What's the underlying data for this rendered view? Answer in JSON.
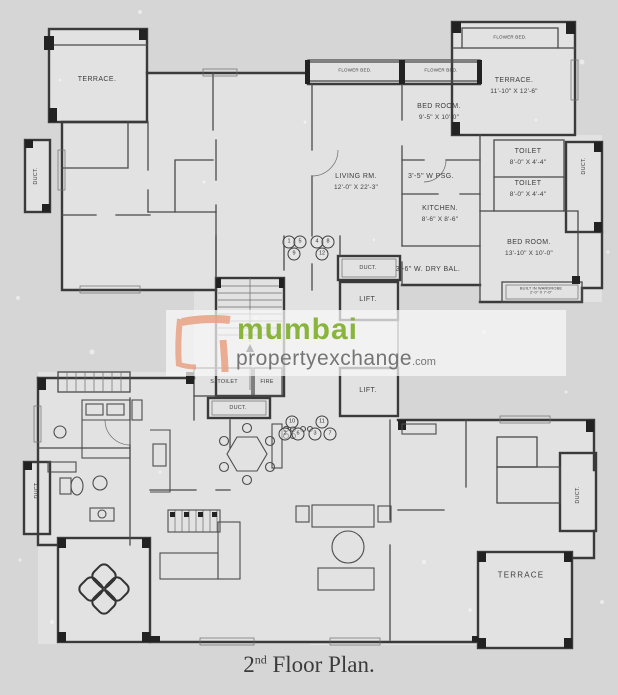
{
  "page": {
    "background": "#d6d6d6",
    "wall_color": "#3a3a3a"
  },
  "watermark": {
    "brand_green_text": "mumbai",
    "brand_gray_text": "propertyexchange",
    "brand_suffix": ".com",
    "green": "#8ab53c",
    "gray": "#757575",
    "logo_orange": "#e9a284"
  },
  "caption": {
    "prefix": "2",
    "ordinal": "nd",
    "rest": " Floor Plan."
  },
  "plan": {
    "rooms": {
      "terrace_tl": {
        "name": "TERRACE."
      },
      "duct_left_top": {
        "name": "DUCT."
      },
      "flower_bed_1": {
        "name": "FLOWER BED."
      },
      "flower_bed_2": {
        "name": "FLOWER BED."
      },
      "flower_bed_3": {
        "name": "FLOWER BED."
      },
      "bed_room_top": {
        "name": "BED ROOM.",
        "dims": "9'-5\" X 10'-0\""
      },
      "living_rm": {
        "name": "LIVING RM.",
        "dims": "12'-0\" X 22'-3\""
      },
      "psg": {
        "name": "3'-5\" W PSG."
      },
      "kitchen": {
        "name": "KITCHEN.",
        "dims": "8'-6\" X 8'-6\""
      },
      "terrace_tr": {
        "name": "TERRACE.",
        "dims": "11'-10\" X 12'-6\""
      },
      "toilet_1": {
        "name": "TOILET",
        "dims": "8'-0\" X 4'-4\""
      },
      "toilet_2": {
        "name": "TOILET",
        "dims": "8'-0\" X 4'-4\""
      },
      "duct_right_top": {
        "name": "DUCT."
      },
      "bed_room_right": {
        "name": "BED ROOM.",
        "dims": "13'-10\" X 10'-0\""
      },
      "wardrobe": {
        "name": "BUILT IN WARDROBE",
        "dims": "2'-0\" X 7'-0\""
      },
      "dry_bal": {
        "name": "3'-6\" W. DRY BAL."
      },
      "duct_core_top": {
        "name": "DUCT."
      },
      "lift_top": {
        "name": "LIFT."
      },
      "lift_bottom": {
        "name": "LIFT."
      },
      "s_toilet": {
        "name": "S. TOILET"
      },
      "fire": {
        "name": "FIRE"
      },
      "duct_core_bottom": {
        "name": "DUCT."
      },
      "terrace_bottom": {
        "name": "TERRACE"
      },
      "duct_right_bottom": {
        "name": "DUCT."
      },
      "duct_left_bottom": {
        "name": "DUCT."
      }
    },
    "unit_numbers": {
      "group_a": [
        "1",
        "5",
        "9"
      ],
      "group_b": [
        "4",
        "8",
        "12"
      ],
      "group_c": [
        "10",
        "2",
        "6"
      ],
      "group_d": [
        "11",
        "3",
        "7"
      ]
    }
  }
}
